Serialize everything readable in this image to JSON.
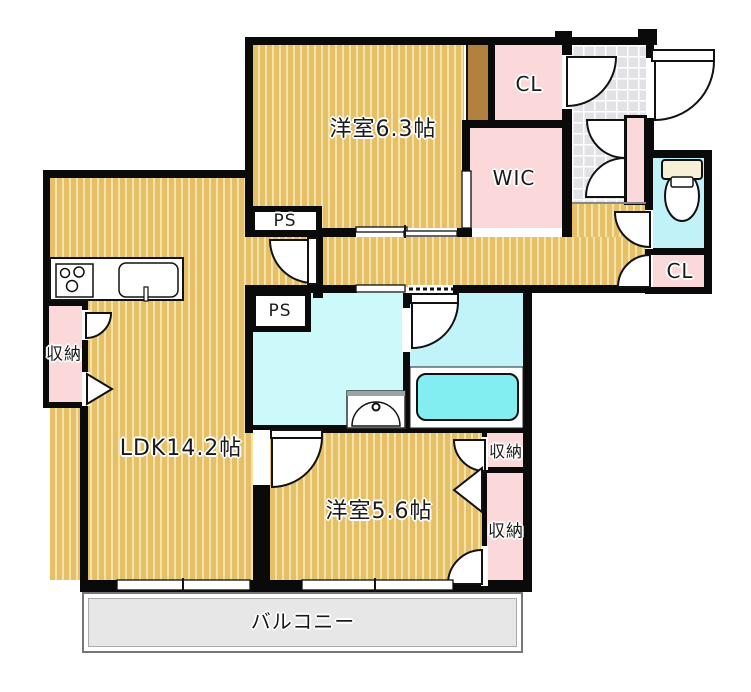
{
  "rooms": {
    "bedroom1": {
      "label": "洋室6.3帖"
    },
    "ldk": {
      "label": "LDK14.2帖"
    },
    "bedroom2": {
      "label": "洋室5.6帖"
    },
    "wic": {
      "label": "WIC"
    },
    "closet_top": {
      "label": "CL"
    },
    "closet_hall": {
      "label": "CL"
    },
    "pipe_space_upper": {
      "label": "PS"
    },
    "pipe_space_lower": {
      "label": "PS"
    },
    "storage_kitchen": {
      "label": "収納"
    },
    "storage_bedroom2_upper": {
      "label": "収納"
    },
    "storage_bedroom2_lower": {
      "label": "収納"
    },
    "balcony": {
      "label": "バルコニー"
    }
  },
  "colors": {
    "floor": "#e5c068",
    "stripe": "#f5e3a6",
    "closet": "#fbd8da",
    "tile": "#e2e2e6",
    "washroom": "#ccfafa",
    "bathroom": "#c0f4f8",
    "bathtub": "#82eef2",
    "toilet_room": "#c0f2f8",
    "wall": "#0a0a0a",
    "brown": "#b3813e",
    "balcony": "#e7e7e7"
  }
}
